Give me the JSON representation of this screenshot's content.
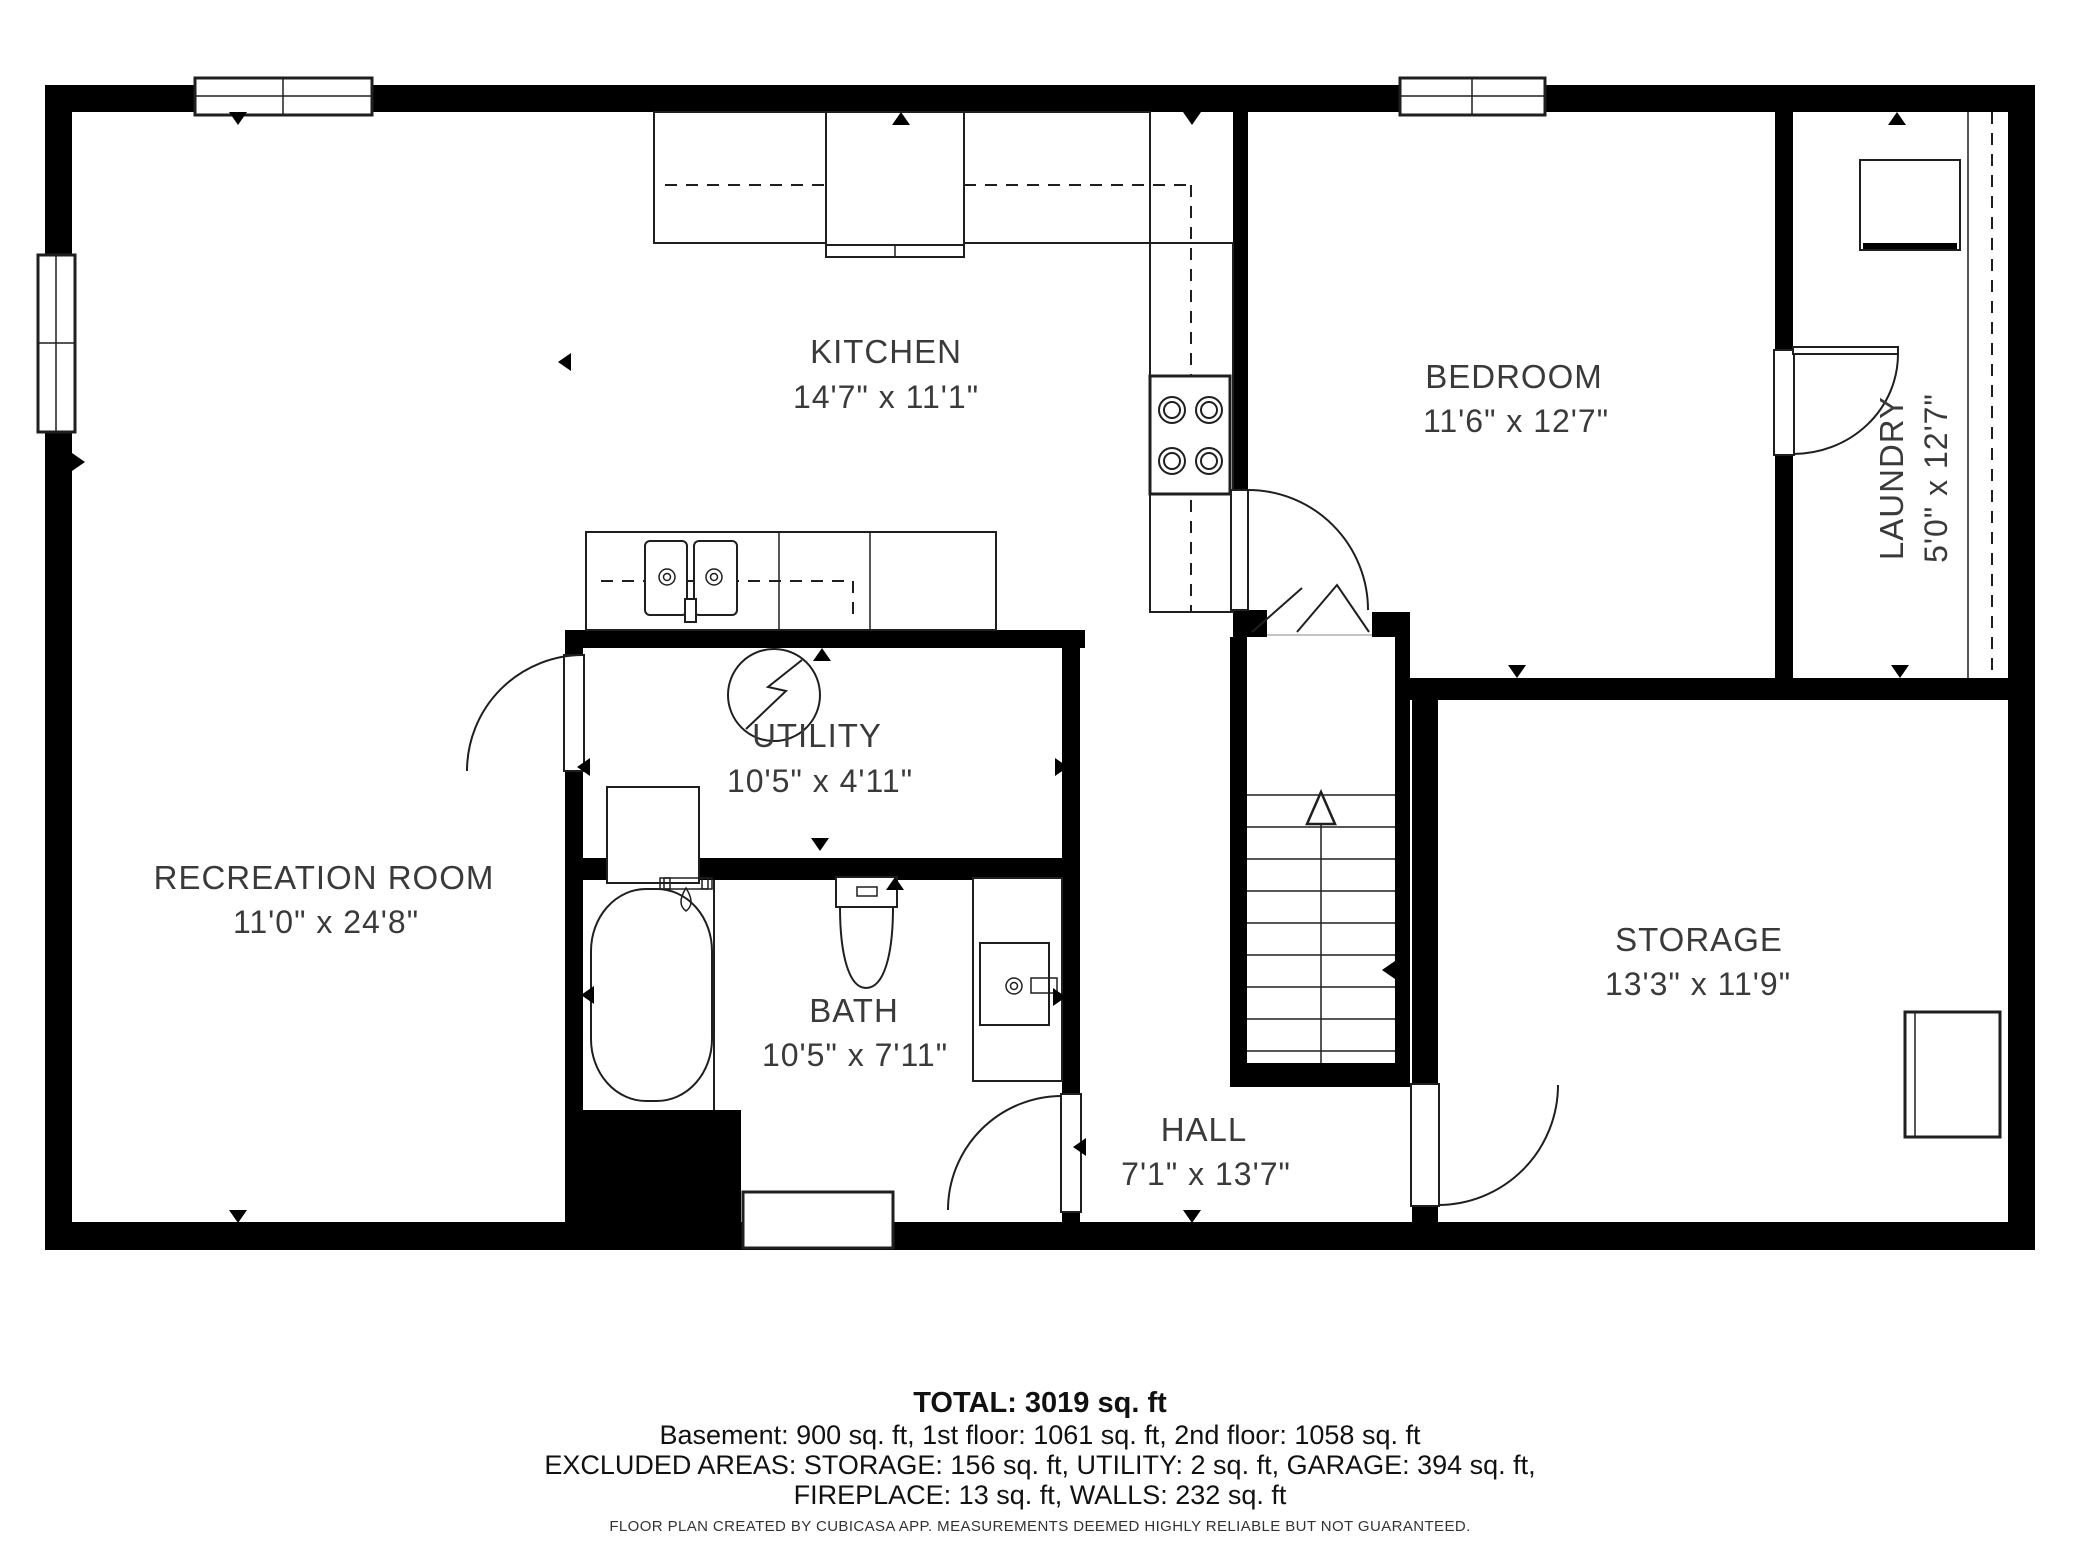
{
  "app": "CubiCasa floor plan",
  "floor": "Basement",
  "rooms": [
    {
      "name": "KITCHEN",
      "dims": "14'7\" x 11'1\""
    },
    {
      "name": "BEDROOM",
      "dims": "11'6\" x 12'7\""
    },
    {
      "name": "LAUNDRY",
      "dims": "5'0\" x 12'7\""
    },
    {
      "name": "UTILITY",
      "dims": "10'5\" x 4'11\""
    },
    {
      "name": "RECREATION ROOM",
      "dims": "11'0\" x 24'8\""
    },
    {
      "name": "BATH",
      "dims": "10'5\" x 7'11\""
    },
    {
      "name": "HALL",
      "dims": "7'1\" x 13'7\""
    },
    {
      "name": "STORAGE",
      "dims": "13'3\" x 11'9\""
    }
  ],
  "summary": {
    "total": "TOTAL: 3019 sq. ft",
    "breakdown": "Basement: 900 sq. ft, 1st floor: 1061 sq. ft, 2nd floor: 1058 sq. ft",
    "excluded1": "EXCLUDED AREAS: STORAGE: 156 sq. ft, UTILITY: 2 sq. ft, GARAGE: 394 sq. ft,",
    "excluded2": "FIREPLACE: 13 sq. ft, WALLS: 232 sq. ft",
    "disclaimer": "FLOOR PLAN CREATED BY CUBICASA APP. MEASUREMENTS DEEMED HIGHLY RELIABLE BUT NOT GUARANTEED."
  },
  "colors": {
    "wall": "#000000",
    "line": "#1f1f1f",
    "label_text": "#3a3a3a",
    "summary_text": "#111111",
    "background": "#ffffff"
  },
  "icons": [
    "stove-icon",
    "fridge-icon",
    "double-sink-icon",
    "furnace-icon",
    "water-heater-icon",
    "bathtub-icon",
    "toilet-icon",
    "vanity-sink-icon",
    "washer-icon",
    "stairs-icon",
    "door-swing-icon",
    "window-icon"
  ]
}
